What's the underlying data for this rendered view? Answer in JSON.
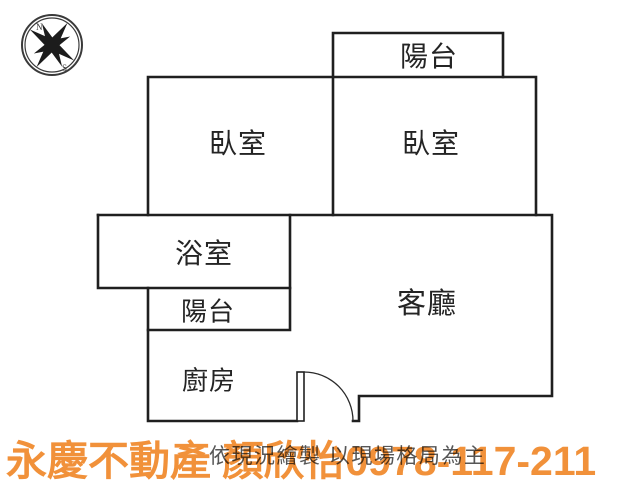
{
  "compass": {
    "north": "N",
    "south": "S"
  },
  "rooms": [
    {
      "id": "balcony-top",
      "label": "陽台"
    },
    {
      "id": "bedroom-left",
      "label": "臥室"
    },
    {
      "id": "bedroom-right",
      "label": "臥室"
    },
    {
      "id": "bathroom",
      "label": "浴室"
    },
    {
      "id": "balcony-lower",
      "label": "陽台"
    },
    {
      "id": "kitchen",
      "label": "廚房"
    },
    {
      "id": "living-room",
      "label": "客廳"
    }
  ],
  "disclaimer": "依現況繪製 以現場格局為主",
  "watermark": {
    "text": "永慶不動產 顏欣怡0978-117-211",
    "color": "#F1913A"
  }
}
